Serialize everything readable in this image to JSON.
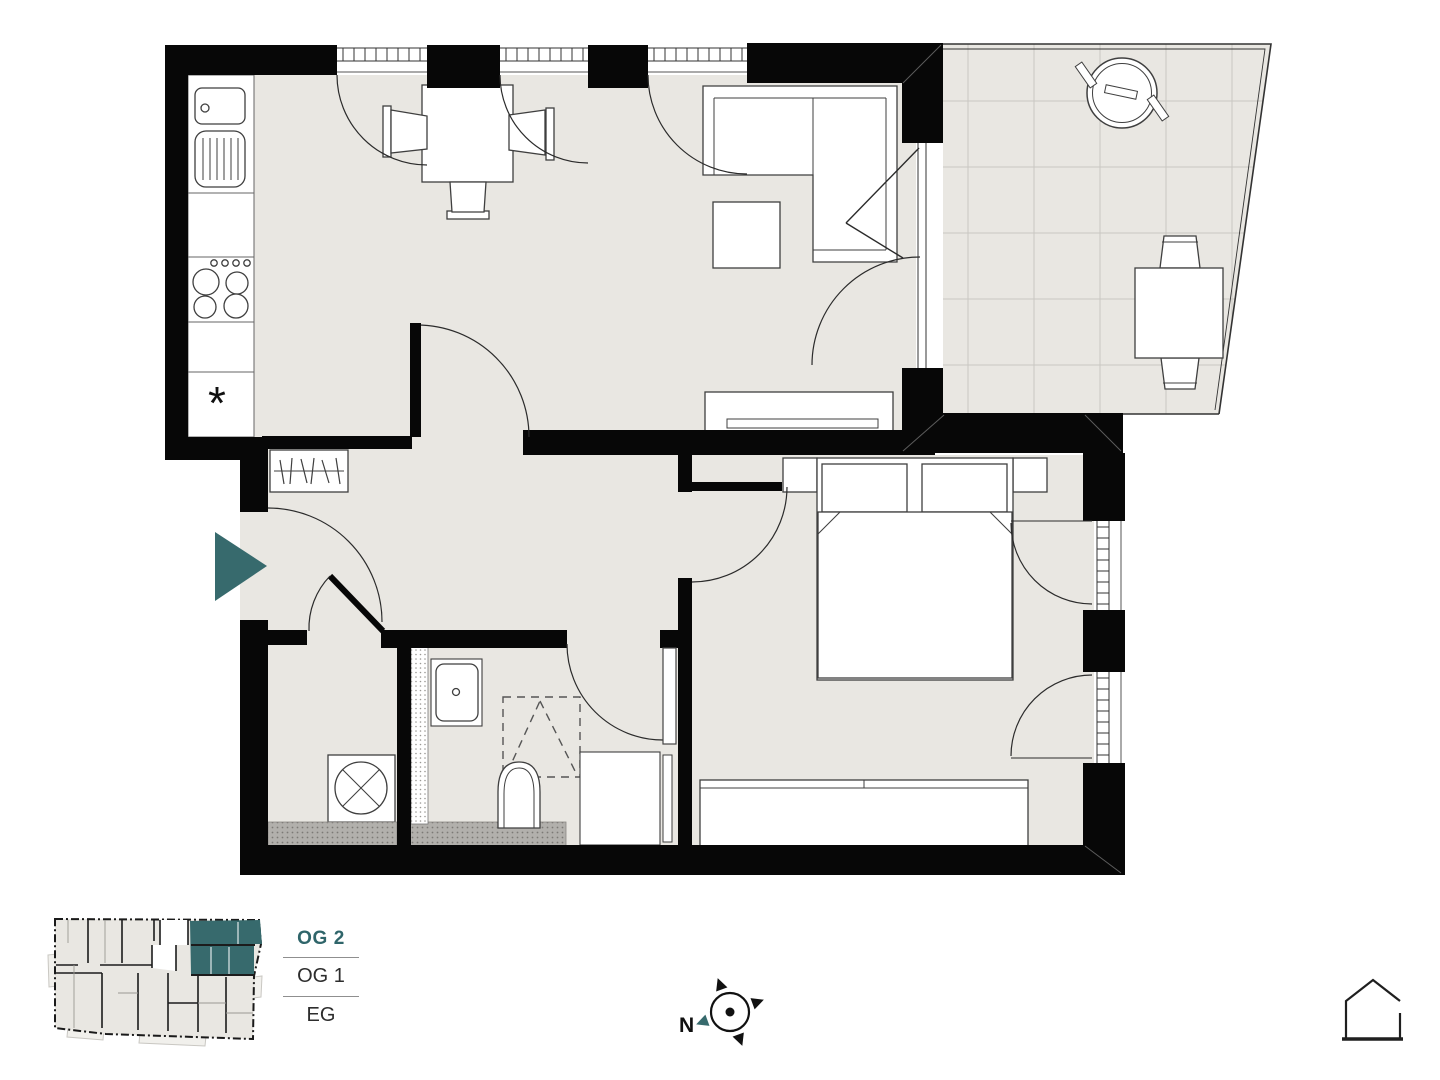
{
  "floor_selector": {
    "current": "OG 2",
    "items": [
      {
        "label": "OG 1"
      },
      {
        "label": "EG"
      }
    ]
  },
  "compass": {
    "north_label": "N"
  },
  "kitchen": {
    "appliance_symbol": "*"
  },
  "colors": {
    "accent_teal": "#376a6d",
    "wall": "#070707",
    "floor": "#e9e7e2",
    "floor_light": "#f1f0ec",
    "outline": "#3f3f3f",
    "tile_line": "#c9c7c2",
    "stipple_dark": "#b2b0ac"
  },
  "icons": {
    "entrance_arrow": "triangle-right",
    "compass": "compass-rose",
    "home": "house-outline"
  }
}
